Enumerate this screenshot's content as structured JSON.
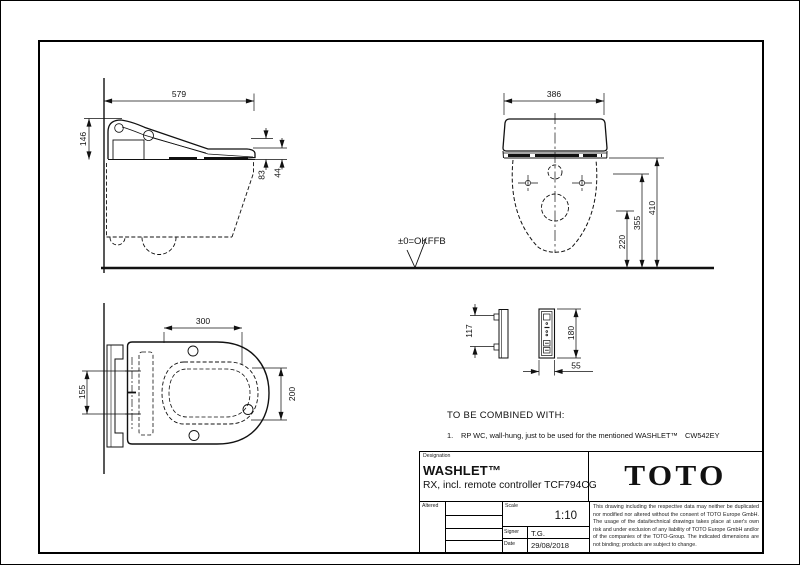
{
  "colors": {
    "line": "#111111",
    "background": "#ffffff"
  },
  "drawing": {
    "floor_label": "±0=OKFFB",
    "side_view": {
      "width": "579",
      "height": "146",
      "h1": "83",
      "h2": "44"
    },
    "front_view": {
      "width": "386",
      "h1": "410",
      "h2": "355",
      "h3": "220"
    },
    "plan_view": {
      "depth": "300",
      "pitch": "155",
      "opening": "200"
    },
    "remote": {
      "pitch": "117",
      "height": "180",
      "width": "55"
    }
  },
  "notes": {
    "heading": "TO BE COMBINED WITH:",
    "items": [
      {
        "no": "1.",
        "text": "RP WC, wall-hung, just to be used for the mentioned WASHLET™",
        "code": "CW542EY"
      }
    ]
  },
  "title_block": {
    "designation_label": "Designation",
    "product": "WASHLET™",
    "description": "RX, incl. remote controller TCF794CG",
    "brand": "TOTO",
    "altered_label": "Altered",
    "scale_label": "Scale",
    "scale_value": "1:10",
    "signer_label": "Signer",
    "signer_value": "T.G.",
    "date_label": "Date",
    "date_value": "29/08/2018",
    "disclaimer": "This drawing including the respective data may neither be duplicated nor modified nor altered without the consent of TOTO Europe GmbH. The usage of the data/technical drawings takes place at user's own risk and under exclusion of any liability of TOTO Europe GmbH and/or of the companies of the TOTO-Group. The indicated dimensions are not binding; products are subject to change."
  }
}
